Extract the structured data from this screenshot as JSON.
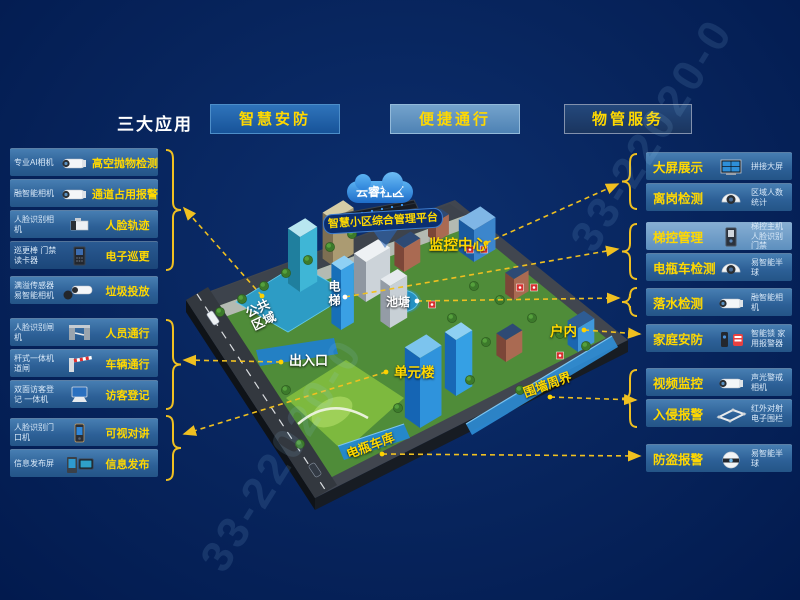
{
  "header": {
    "title": "三大应用",
    "apps": [
      {
        "label": "智慧安防"
      },
      {
        "label": "便捷通行"
      },
      {
        "label": "物管服务"
      }
    ]
  },
  "left_groups": [
    {
      "rows": [
        {
          "device": "专业AI相机",
          "icon": "bullet-camera",
          "label": "高空抛物检测"
        },
        {
          "device": "融智能相机",
          "icon": "bullet-camera",
          "label": "通道占用报警"
        },
        {
          "device": "人脸识别相机",
          "icon": "box-camera",
          "label": "人脸轨迹"
        },
        {
          "device": "巡更棒 门禁读卡器",
          "icon": "card-reader",
          "label": "电子巡更",
          "variant": "dark"
        }
      ]
    },
    {
      "rows": [
        {
          "device": "满溢传感器 易智能相机",
          "icon": "bullet-camera-sensor",
          "label": "垃圾投放"
        }
      ]
    },
    {
      "rows": [
        {
          "device": "人脸识别闸机",
          "icon": "turnstile",
          "label": "人员通行"
        },
        {
          "device": "杆式一体机 道闸",
          "icon": "barrier-gate",
          "label": "车辆通行"
        },
        {
          "device": "双面访客登记 一体机",
          "icon": "visitor-terminal",
          "label": "访客登记"
        }
      ]
    },
    {
      "rows": [
        {
          "device": "人脸识别门口机",
          "icon": "door-station",
          "label": "可视对讲"
        },
        {
          "device": "信息发布屏",
          "icon": "info-screen",
          "label": "信息发布"
        }
      ]
    }
  ],
  "right_groups": [
    {
      "rows": [
        {
          "label": "大屏展示",
          "icon": "video-wall",
          "device": "拼接大屏"
        },
        {
          "label": "离岗检测",
          "icon": "dome-camera",
          "device": "区域人数统计"
        }
      ]
    },
    {
      "rows": [
        {
          "label": "梯控管理",
          "icon": "elevator-panel",
          "device": "梯控主机 人脸识别门禁",
          "variant": "light"
        },
        {
          "label": "电瓶车检测",
          "icon": "dome-camera",
          "device": "易智能半球"
        }
      ]
    },
    {
      "rows": [
        {
          "label": "落水检测",
          "icon": "bullet-camera",
          "device": "融智能相机"
        }
      ]
    },
    {
      "rows": [
        {
          "label": "家庭安防",
          "icon": "lock-siren",
          "device": "智能锁 家用报警器"
        }
      ]
    },
    {
      "rows": [
        {
          "label": "视频监控",
          "icon": "bullet-camera",
          "device": "声光警戒相机"
        },
        {
          "label": "入侵报警",
          "icon": "fence",
          "device": "红外对射 电子围栏"
        }
      ]
    },
    {
      "rows": [
        {
          "label": "防盗报警",
          "icon": "turret-camera",
          "device": "易智能半球"
        }
      ]
    }
  ],
  "map": {
    "cloud": "云睿社区",
    "platform": "智慧小区综合管理平台",
    "labels": {
      "monitoring_center": "监控中心",
      "elevator": "电梯",
      "pond": "池塘",
      "public_area": "公共区域",
      "entrance": "出入口",
      "unit_building": "单元楼",
      "indoor": "户内",
      "perimeter": "围墙周界",
      "bike_garage": "电瓶车库"
    }
  },
  "watermark": "33-22020-0",
  "colors": {
    "accent_yellow": "#ffd800",
    "bar_blue": "#2e6aa8",
    "highlight_blue": "#2e8fd8",
    "background_navy": "#07245c"
  }
}
